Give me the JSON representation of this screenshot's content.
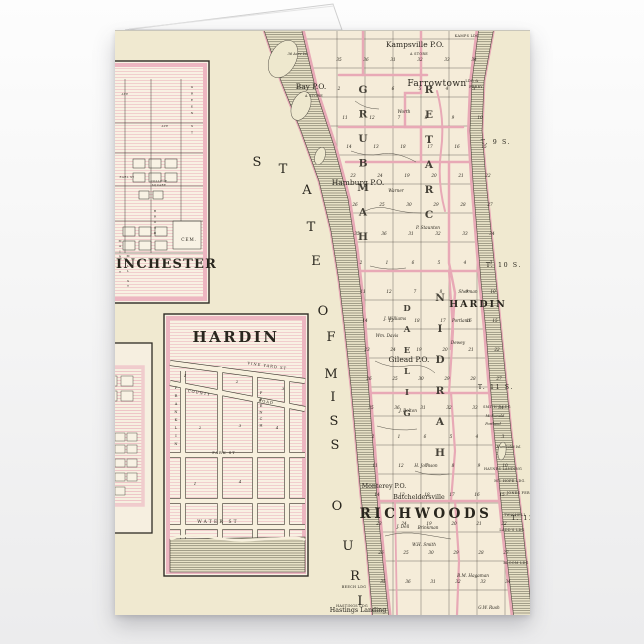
{
  "scene": {
    "background_top": "#fdfdfd",
    "background_bottom": "#ececed",
    "paper_color": "#f0e9d0",
    "pink_color": "#e8a9b6",
    "ink_color": "#29261e"
  },
  "map": {
    "labels": [
      {
        "text": "Kampsville P.O.",
        "x": 300,
        "y": 16,
        "cls": "town"
      },
      {
        "text": "A STORE",
        "x": 304,
        "y": 24,
        "cls": "tiny"
      },
      {
        "text": "Bay P.O.",
        "x": 196,
        "y": 58,
        "cls": "town"
      },
      {
        "text": "A STORE",
        "x": 199,
        "y": 66,
        "cls": "tiny"
      },
      {
        "text": "Farrowtown",
        "x": 322,
        "y": 55,
        "cls": "town-lg"
      },
      {
        "text": "LDG &",
        "x": 357,
        "y": 51,
        "cls": "tiny"
      },
      {
        "text": "FERRY",
        "x": 361,
        "y": 57,
        "cls": "tiny"
      },
      {
        "text": "KAMPS LDG",
        "x": 352,
        "y": 6,
        "cls": "tiny"
      },
      {
        "text": "Hamburg P.O.",
        "x": 243,
        "y": 154,
        "cls": "town"
      },
      {
        "text": "Gilead P.O.",
        "x": 294,
        "y": 331,
        "cls": "town"
      },
      {
        "text": "HARDIN",
        "x": 363,
        "y": 276,
        "cls": "cap"
      },
      {
        "text": "RICHWOODS",
        "x": 311,
        "y": 487,
        "cls": "big"
      },
      {
        "text": "Monterey P.O.",
        "x": 269,
        "y": 457,
        "cls": "town-sm"
      },
      {
        "text": "Batcheldersville",
        "x": 304,
        "y": 468,
        "cls": "town-sm"
      },
      {
        "text": "Hastings Landing",
        "x": 243,
        "y": 581,
        "cls": "town-sm"
      },
      {
        "text": "T. 9 S.",
        "x": 381,
        "y": 113,
        "cls": "tier"
      },
      {
        "text": "T. 10 S.",
        "x": 389,
        "y": 236,
        "cls": "tier"
      },
      {
        "text": "T. 11 S.",
        "x": 381,
        "y": 358,
        "cls": "tier"
      },
      {
        "text": "T. 12",
        "x": 408,
        "y": 489,
        "cls": "tier"
      },
      {
        "text": "Worth",
        "x": 289,
        "y": 82,
        "cls": "owner"
      },
      {
        "text": "Warner",
        "x": 281,
        "y": 161,
        "cls": "owner"
      },
      {
        "text": "P. Staunton",
        "x": 313,
        "y": 198,
        "cls": "owner"
      },
      {
        "text": "Sherman",
        "x": 353,
        "y": 262,
        "cls": "owner"
      },
      {
        "text": "Portland",
        "x": 346,
        "y": 291,
        "cls": "owner"
      },
      {
        "text": "Dewey",
        "x": 343,
        "y": 313,
        "cls": "owner"
      },
      {
        "text": "J. Bolton",
        "x": 293,
        "y": 381,
        "cls": "owner"
      },
      {
        "text": "H. Johnson",
        "x": 311,
        "y": 436,
        "cls": "owner"
      },
      {
        "text": "Wm. Davis",
        "x": 272,
        "y": 306,
        "cls": "owner"
      },
      {
        "text": "J. Williams",
        "x": 280,
        "y": 289,
        "cls": "owner"
      },
      {
        "text": "J. Dell",
        "x": 288,
        "y": 497,
        "cls": "owner"
      },
      {
        "text": "Brinkman",
        "x": 313,
        "y": 498,
        "cls": "owner"
      },
      {
        "text": "W.H. Smith",
        "x": 309,
        "y": 515,
        "cls": "owner"
      },
      {
        "text": "B.M. Hagaman",
        "x": 358,
        "y": 546,
        "cls": "owner"
      },
      {
        "text": "G.W. Rush",
        "x": 374,
        "y": 578,
        "cls": "owner"
      },
      {
        "text": "McDonald",
        "x": 380,
        "y": 386,
        "cls": "owner-sm"
      },
      {
        "text": "Portland",
        "x": 378,
        "y": 394,
        "cls": "owner-sm"
      },
      {
        "text": "Humboldt Isl.",
        "x": 394,
        "y": 417,
        "cls": "owner-sm"
      },
      {
        "text": "36 Acre Isl.",
        "x": 183,
        "y": 24,
        "cls": "owner-sm"
      },
      {
        "text": "SMITH'S LDG",
        "x": 382,
        "y": 377,
        "cls": "tiny"
      },
      {
        "text": "HAYNES LANDING",
        "x": 388,
        "y": 439,
        "cls": "tiny"
      },
      {
        "text": "MT. HOPE LDG.",
        "x": 395,
        "y": 451,
        "cls": "tiny"
      },
      {
        "text": "JONES FER.",
        "x": 404,
        "y": 463,
        "cls": "tiny"
      },
      {
        "text": "TWICHELL",
        "x": 400,
        "y": 485,
        "cls": "tiny"
      },
      {
        "text": "LADD'S LDG",
        "x": 397,
        "y": 500,
        "cls": "tiny"
      },
      {
        "text": "BLOOM LDG",
        "x": 401,
        "y": 533,
        "cls": "tiny"
      },
      {
        "text": "BEECH LDG",
        "x": 239,
        "y": 557,
        "cls": "tiny"
      },
      {
        "text": "HASTINGS LDG",
        "x": 237,
        "y": 576,
        "cls": "tiny"
      },
      {
        "text": "INCHESTER",
        "x": 1,
        "y": 237,
        "cls": "inset2",
        "anchor": "start"
      },
      {
        "text": "CEM.",
        "x": 74,
        "y": 210,
        "cls": "cem"
      },
      {
        "text": "EARL ST",
        "x": 12,
        "y": 147,
        "cls": "street-sm"
      },
      {
        "text": "COLLEGE",
        "x": 44,
        "y": 151,
        "cls": "street-sm"
      },
      {
        "text": "SQUARE",
        "x": 44,
        "y": 155,
        "cls": "street-sm"
      },
      {
        "text": "AVE",
        "x": 50,
        "y": 96,
        "cls": "street-sm"
      },
      {
        "text": "AVE",
        "x": 10,
        "y": 64,
        "cls": "street-sm"
      },
      {
        "text": "HARDIN",
        "x": 121,
        "y": 311,
        "cls": "inset1"
      },
      {
        "text": "VINE YARD ST",
        "x": 152,
        "y": 336,
        "cls": "street",
        "rot": 8
      },
      {
        "text": "COUNTY",
        "x": 84,
        "y": 363,
        "cls": "street",
        "rot": 9
      },
      {
        "text": "ROAD",
        "x": 151,
        "y": 372,
        "cls": "street",
        "rot": 9
      },
      {
        "text": "PARK ST",
        "x": 109,
        "y": 423,
        "cls": "street"
      },
      {
        "text": "WATER ST",
        "x": 103,
        "y": 492,
        "cls": "street-lg"
      },
      {
        "text": "1",
        "x": 70,
        "y": 346,
        "cls": "num"
      },
      {
        "text": "2",
        "x": 122,
        "y": 352,
        "cls": "num"
      },
      {
        "text": "3",
        "x": 168,
        "y": 359,
        "cls": "num"
      },
      {
        "text": "2",
        "x": 85,
        "y": 398,
        "cls": "num"
      },
      {
        "text": "3",
        "x": 125,
        "y": 396,
        "cls": "num"
      },
      {
        "text": "4",
        "x": 162,
        "y": 398,
        "cls": "num"
      },
      {
        "text": "1",
        "x": 80,
        "y": 454,
        "cls": "num"
      },
      {
        "text": "4",
        "x": 125,
        "y": 452,
        "cls": "num"
      },
      {
        "text": "S",
        "x": 142,
        "y": 135,
        "cls": "state"
      },
      {
        "text": "T",
        "x": 168,
        "y": 142,
        "cls": "state"
      },
      {
        "text": "A",
        "x": 192,
        "y": 163,
        "cls": "state"
      },
      {
        "text": "T",
        "x": 196,
        "y": 200,
        "cls": "state"
      },
      {
        "text": "E",
        "x": 201,
        "y": 234,
        "cls": "state"
      },
      {
        "text": "O",
        "x": 208,
        "y": 284,
        "cls": "state"
      },
      {
        "text": "F",
        "x": 216,
        "y": 310,
        "cls": "state"
      },
      {
        "text": "M",
        "x": 216,
        "y": 347,
        "cls": "state"
      },
      {
        "text": "I",
        "x": 218,
        "y": 370,
        "cls": "state"
      },
      {
        "text": "S",
        "x": 219,
        "y": 394,
        "cls": "state"
      },
      {
        "text": "S",
        "x": 220,
        "y": 418,
        "cls": "state"
      },
      {
        "text": "O",
        "x": 222,
        "y": 479,
        "cls": "state"
      },
      {
        "text": "U",
        "x": 233,
        "y": 519,
        "cls": "state"
      },
      {
        "text": "R",
        "x": 240,
        "y": 549,
        "cls": "state"
      },
      {
        "text": "I",
        "x": 245,
        "y": 574,
        "cls": "state"
      }
    ],
    "stacked": [
      {
        "text": "HAMBURG",
        "x": 248,
        "y": 62,
        "step": 24.5,
        "dir": "up",
        "cls": "twp"
      },
      {
        "text": "CRATER",
        "x": 314,
        "y": 62,
        "step": 25,
        "dir": "up",
        "cls": "twp"
      },
      {
        "text": "GILEAD",
        "x": 292,
        "y": 280,
        "step": 21,
        "dir": "up",
        "cls": "twp-sm"
      },
      {
        "text": "HARDIN",
        "x": 325,
        "y": 270,
        "step": 31,
        "dir": "up",
        "cls": "twp"
      },
      {
        "text": "FRANKLIN",
        "x": 61,
        "y": 358,
        "step": 8,
        "dir": "down",
        "cls": "street-v"
      },
      {
        "text": "FRENCH",
        "x": 146,
        "y": 363,
        "step": 6.5,
        "dir": "down",
        "cls": "street-v"
      },
      {
        "text": "GREEN ST",
        "x": 77,
        "y": 57,
        "step": 6.5,
        "dir": "down",
        "cls": "street-vs"
      },
      {
        "text": "BROAD",
        "x": 40,
        "y": 181,
        "step": 5.5,
        "dir": "down",
        "cls": "street-vs"
      },
      {
        "text": "MAIN ST",
        "x": 5,
        "y": 211,
        "step": 5.2,
        "dir": "down",
        "cls": "street-vs"
      },
      {
        "text": "MILL ST",
        "x": 13,
        "y": 226,
        "step": 5,
        "dir": "down",
        "cls": "street-vs"
      }
    ],
    "section_rows": [
      {
        "y": 30,
        "x": 224,
        "step": 27,
        "v": [
          35,
          36,
          31,
          32,
          33,
          34
        ]
      },
      {
        "y": 59,
        "x": 224,
        "step": 27,
        "v": [
          2,
          1,
          6,
          5,
          4,
          3
        ]
      },
      {
        "y": 88,
        "x": 230,
        "step": 27,
        "v": [
          11,
          12,
          7,
          8,
          9,
          10
        ]
      },
      {
        "y": 117,
        "x": 234,
        "step": 27,
        "v": [
          14,
          13,
          18,
          17,
          16,
          15
        ]
      },
      {
        "y": 146,
        "x": 238,
        "step": 27,
        "v": [
          23,
          24,
          19,
          20,
          21,
          22
        ]
      },
      {
        "y": 175,
        "x": 240,
        "step": 27,
        "v": [
          26,
          25,
          30,
          29,
          28,
          27
        ]
      },
      {
        "y": 204,
        "x": 242,
        "step": 27,
        "v": [
          35,
          36,
          31,
          32,
          33,
          34
        ]
      },
      {
        "y": 233,
        "x": 246,
        "step": 26,
        "v": [
          2,
          1,
          6,
          5,
          4,
          3
        ]
      },
      {
        "y": 262,
        "x": 248,
        "step": 26,
        "v": [
          11,
          12,
          7,
          8,
          9,
          10
        ]
      },
      {
        "y": 291,
        "x": 250,
        "step": 26,
        "v": [
          14,
          13,
          18,
          17,
          16,
          15
        ]
      },
      {
        "y": 320,
        "x": 252,
        "step": 26,
        "v": [
          23,
          24,
          19,
          20,
          21,
          22
        ]
      },
      {
        "y": 349,
        "x": 254,
        "step": 26,
        "v": [
          26,
          25,
          30,
          29,
          28,
          27
        ]
      },
      {
        "y": 378,
        "x": 256,
        "step": 26,
        "v": [
          35,
          36,
          31,
          32,
          33,
          34
        ]
      },
      {
        "y": 407,
        "x": 258,
        "step": 26,
        "v": [
          2,
          1,
          6,
          5,
          4,
          3
        ]
      },
      {
        "y": 436,
        "x": 260,
        "step": 26,
        "v": [
          11,
          12,
          7,
          8,
          9,
          10
        ]
      },
      {
        "y": 465,
        "x": 262,
        "step": 25,
        "v": [
          14,
          13,
          18,
          17,
          16,
          15
        ]
      },
      {
        "y": 494,
        "x": 264,
        "step": 25,
        "v": [
          23,
          24,
          19,
          20,
          21,
          22
        ]
      },
      {
        "y": 523,
        "x": 266,
        "step": 25,
        "v": [
          26,
          25,
          30,
          29,
          28,
          27
        ]
      },
      {
        "y": 552,
        "x": 268,
        "step": 25,
        "v": [
          35,
          36,
          31,
          32,
          33,
          34
        ]
      }
    ]
  }
}
